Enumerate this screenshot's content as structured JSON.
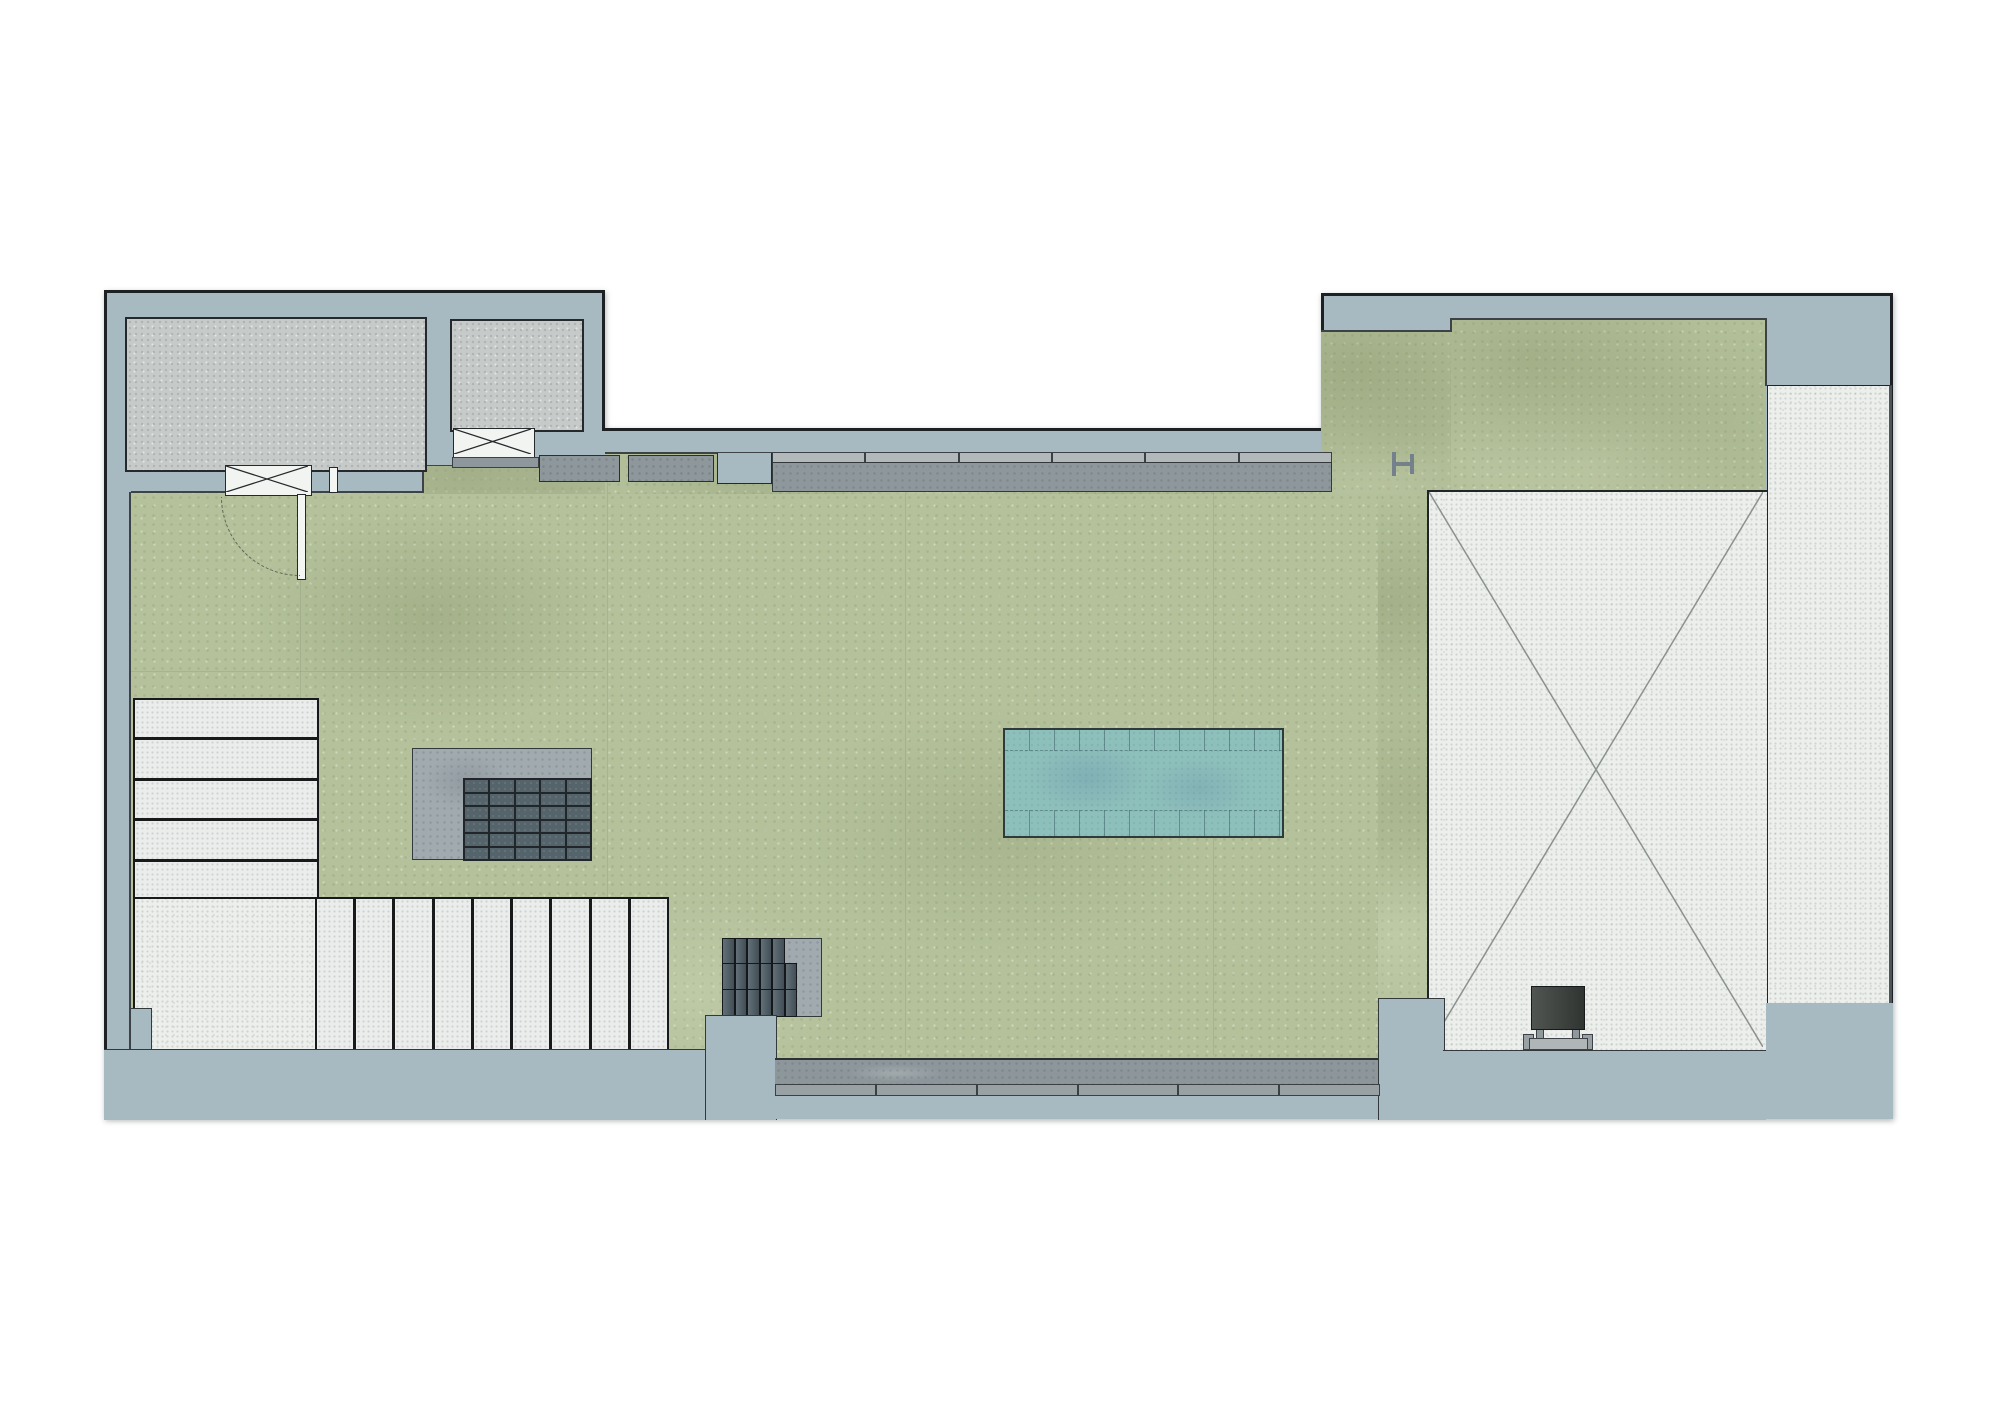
{
  "page": {
    "title": "Roof terrace landscape plan",
    "type": "architectural plan drawing",
    "canvas_px": {
      "width": 2000,
      "height": 1414
    },
    "visible_text": []
  },
  "colors": {
    "canvas": "#ffffff",
    "outline": "#1d2123",
    "wall_band": "#a7bac2",
    "lawn": "#b4c19b",
    "room_fill": "#c6cac9",
    "white_surface": "#ecefec",
    "platform_gray": "#a1aaaf",
    "paver_dark": "#55636b",
    "grid_line": "#20262a",
    "solar_slat": "#4e5c64",
    "planter_body": "#8e979b",
    "planter_cap": "#b3b9bb",
    "pool_water": "#8ec0bb",
    "pool_edge": "#2f3a3d",
    "bench_dark": "#3c423e",
    "metal_gray": "#75818a"
  },
  "plan": {
    "rooms": {
      "count": 2
    },
    "window_openings": {
      "count": 2
    },
    "stairs": {
      "upper_flight_treads": 5,
      "lower_flight_treads": 9
    },
    "platform_deck": {
      "paver_columns": 5,
      "paver_rows": 6,
      "paver_cells": 30
    },
    "solar_canopy": {
      "row_cells": [
        5,
        6,
        6
      ]
    },
    "perimeter_planter": {
      "cap_segments": 6
    },
    "south_paving": {
      "segments": 6
    },
    "pool": {
      "tile_columns": 11
    },
    "skylight": {
      "count": 1,
      "marking": "diagonal-cross"
    }
  }
}
